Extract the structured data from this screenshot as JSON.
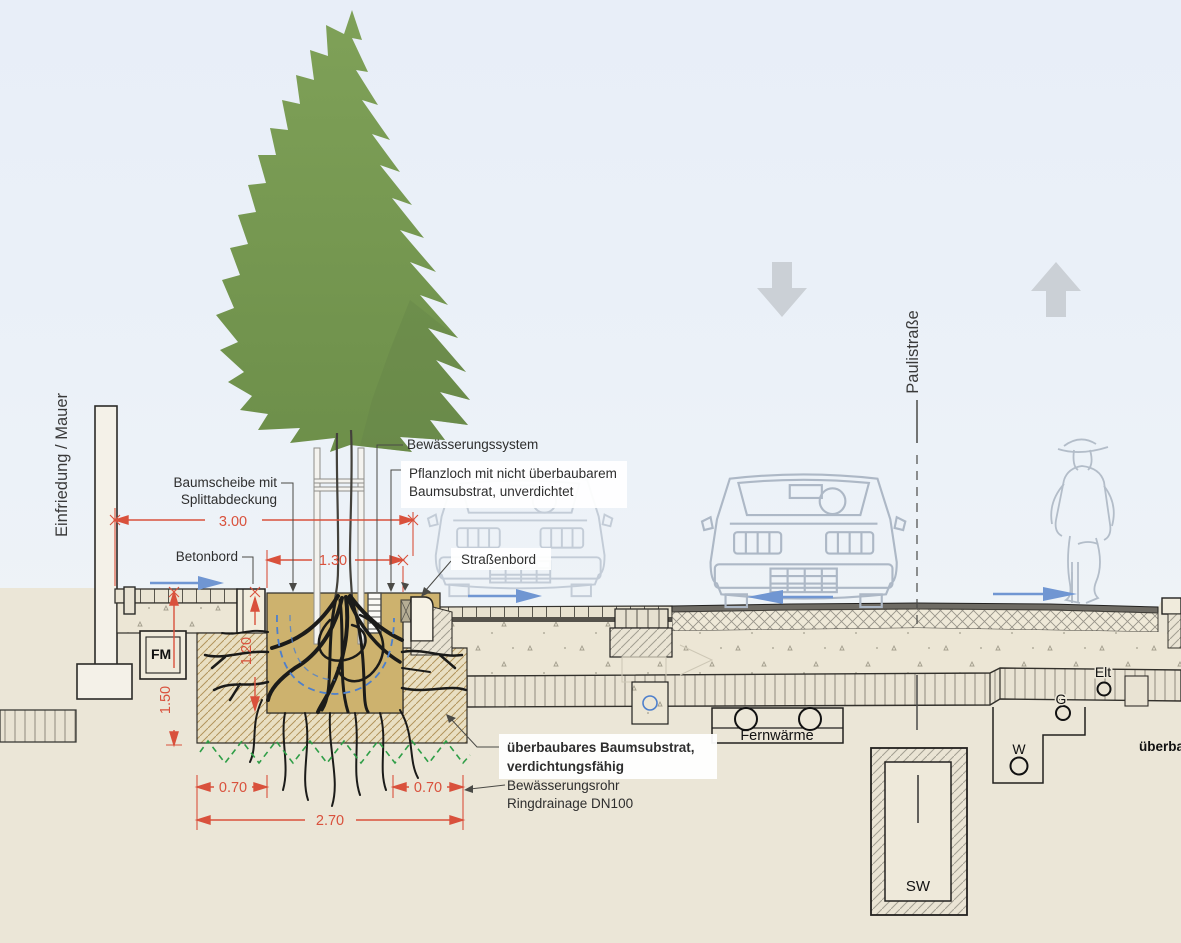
{
  "diagram": {
    "street_name": "Paulistraße",
    "labels": {
      "einfriedung": "Einfriedung / Mauer",
      "baumscheibe_line1": "Baumscheibe mit",
      "baumscheibe_line2": "Splittabdeckung",
      "betonbord": "Betonbord",
      "bewaesserungssystem": "Bewässerungssystem",
      "pflanzloch_line1": "Pflanzloch mit nicht überbaubarem",
      "pflanzloch_line2": "Baumsubstrat, unverdichtet",
      "strassenbord": "Straßenbord",
      "ueberbaubar_line1": "überbaubares Baumsubstrat,",
      "ueberbaubar_line2": "verdichtungsfähig",
      "bewaesserungsrohr_line1": "Bewässerungsrohr",
      "bewaesserungsrohr_line2": "Ringdrainage DN100",
      "fernwaerme": "Fernwärme",
      "fm": "FM",
      "elt": "Elt",
      "g": "G",
      "w": "W",
      "sw": "SW",
      "ueberbaubar_cut": "überba"
    },
    "dimensions": {
      "total_width": "3.00",
      "pit_width": "1.30",
      "depth_total": "1.50",
      "depth_pit": "1.20",
      "offset_left": "0.70",
      "offset_right": "0.70",
      "substrate_width": "2.70"
    },
    "colors": {
      "dimension_red": "#d9513c",
      "direction_blue": "#7096d2",
      "canopy_green": "#7a9b52",
      "substrate_tan": "#cdb26e",
      "ground_beige": "#ebe6d7",
      "sky_blue": "#e9eff8"
    }
  }
}
